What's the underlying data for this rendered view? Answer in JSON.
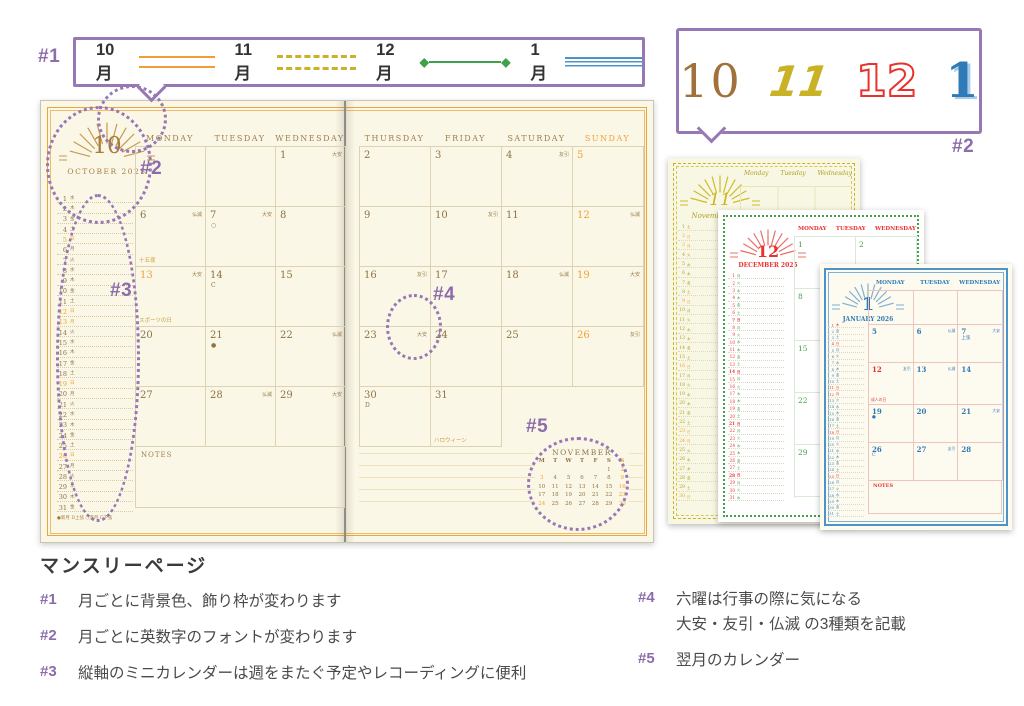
{
  "colors": {
    "purple": "#9678b4",
    "purple_text": "#8d6cab",
    "frame_orange": "#eaa73e",
    "brown": "#8f7344",
    "holiday_orange": "#f0a231",
    "olive": "#c9b225",
    "green": "#3fa14a",
    "red": "#e8322e",
    "blue": "#3f87c2",
    "cream": "#fbf7e7",
    "text_gray": "#4a4a4a"
  },
  "annotations": {
    "n1": "#1",
    "n2": "#2",
    "n3": "#3",
    "n4": "#4",
    "n5": "#5"
  },
  "legend": {
    "items": [
      {
        "month": "10月",
        "line": "orange-double"
      },
      {
        "month": "11月",
        "line": "olive-dashed"
      },
      {
        "month": "12月",
        "line": "green-diamond"
      },
      {
        "month": "1月",
        "line": "blue-triple"
      }
    ]
  },
  "font_samples": [
    "10",
    "11",
    "12",
    "1"
  ],
  "weekday_kanji": [
    "月",
    "火",
    "水",
    "木",
    "金",
    "土",
    "日"
  ],
  "spread": {
    "month_num": "10",
    "month_title": "OCTOBER 2025",
    "left_headers": [
      "MONDAY",
      "TUESDAY",
      "WEDNESDAY"
    ],
    "right_headers": [
      "THURSDAY",
      "FRIDAY",
      "SATURDAY",
      "SUNDAY"
    ],
    "mini": {
      "first_weekday": 2,
      "days": 31,
      "holidays": [
        5,
        12,
        13,
        19,
        26
      ],
      "moon_legend": "●新月 D上弦 ○満月 C下弦"
    },
    "weeks_left": [
      [
        null,
        null,
        {
          "d": 1,
          "r": "大安"
        }
      ],
      [
        {
          "d": 6,
          "r": "仏滅",
          "note": "十五夜"
        },
        {
          "d": 7,
          "r": "大安",
          "moon": "○"
        },
        {
          "d": 8
        }
      ],
      [
        {
          "d": 13,
          "r": "大安",
          "hol": true,
          "note": "スポーツの日"
        },
        {
          "d": 14,
          "moon": "C"
        },
        {
          "d": 15
        }
      ],
      [
        {
          "d": 20
        },
        {
          "d": 21,
          "moon": "●"
        },
        {
          "d": 22,
          "r": "仏滅"
        }
      ],
      [
        {
          "d": 27
        },
        {
          "d": 28,
          "r": "仏滅"
        },
        {
          "d": 29,
          "r": "大安"
        }
      ]
    ],
    "weeks_right": [
      [
        {
          "d": 2
        },
        {
          "d": 3
        },
        {
          "d": 4,
          "r": "友引"
        },
        {
          "d": 5,
          "hol": true
        }
      ],
      [
        {
          "d": 9
        },
        {
          "d": 10,
          "r": "友引"
        },
        {
          "d": 11
        },
        {
          "d": 12,
          "hol": true,
          "r": "仏滅"
        }
      ],
      [
        {
          "d": 16,
          "r": "友引"
        },
        {
          "d": 17
        },
        {
          "d": 18,
          "r": "仏滅"
        },
        {
          "d": 19,
          "hol": true,
          "r": "大安"
        }
      ],
      [
        {
          "d": 23,
          "r": "大安"
        },
        {
          "d": 24
        },
        {
          "d": 25
        },
        {
          "d": 26,
          "hol": true,
          "r": "友引"
        }
      ]
    ],
    "week_right_last": [
      {
        "d": 30,
        "moon": "D"
      },
      {
        "d": 31,
        "note": "ハロウィーン"
      }
    ],
    "notes_label": "NOTES",
    "next_month": {
      "title": "NOVEMBER",
      "header": [
        "M",
        "T",
        "W",
        "T",
        "F",
        "S",
        "S"
      ],
      "first_weekday": 5,
      "days": 30,
      "holidays": [
        2,
        3,
        9,
        16,
        23,
        24,
        30
      ]
    }
  },
  "side_pages": {
    "november": {
      "num": "11",
      "title": "November 2025",
      "headers": [
        "Monday",
        "Tuesday",
        "Wednesday"
      ],
      "first_weekday": 5,
      "days": 30,
      "holidays": [
        2,
        3,
        9,
        16,
        23,
        24,
        30
      ],
      "monday_dates": [
        3,
        10,
        17,
        24
      ]
    },
    "december": {
      "num": "12",
      "title": "DECEMBER 2025",
      "headers": [
        "MONDAY",
        "TUESDAY",
        "WEDNESDAY"
      ],
      "first_weekday": 0,
      "days": 31,
      "holidays": [
        7,
        14,
        21,
        28
      ],
      "monday_dates": [
        1,
        8,
        15,
        22,
        29
      ],
      "row1_extra": [
        2
      ]
    },
    "january": {
      "num": "1",
      "title": "JANUARY 2026",
      "headers": [
        "MONDAY",
        "TUESDAY",
        "WEDNESDAY"
      ],
      "first_weekday": 3,
      "days": 31,
      "holidays": [
        1,
        4,
        11,
        12,
        18,
        25
      ],
      "weeks": [
        [
          null,
          null,
          null
        ],
        [
          {
            "d": 5
          },
          {
            "d": 6,
            "r": "仏滅"
          },
          {
            "d": 7,
            "r": "大安",
            "moon": "上弦"
          }
        ],
        [
          {
            "d": 12,
            "red": true,
            "r": "友引",
            "note": "成人の日"
          },
          {
            "d": 13,
            "r": "仏滅"
          },
          {
            "d": 14
          }
        ],
        [
          {
            "d": 19,
            "moon": "●"
          },
          {
            "d": 20
          },
          {
            "d": 21,
            "r": "大安"
          }
        ],
        [
          {
            "d": 26,
            "moon": "C"
          },
          {
            "d": 27,
            "r": "友引"
          },
          {
            "d": 28
          }
        ]
      ],
      "notes_label": "NOTES"
    }
  },
  "description": {
    "title": "マンスリーページ",
    "items_left": [
      {
        "num": "#1",
        "text": "月ごとに背景色、飾り枠が変わります"
      },
      {
        "num": "#2",
        "text": "月ごとに英数字のフォントが変わります"
      },
      {
        "num": "#3",
        "text": "縦軸のミニカレンダーは週をまたぐ予定やレコーディングに便利"
      }
    ],
    "items_right": [
      {
        "num": "#4",
        "text": "六曜は行事の際に気になる",
        "text2": "大安・友引・仏滅 の3種類を記載"
      },
      {
        "num": "#5",
        "text": "翌月のカレンダー"
      }
    ]
  }
}
